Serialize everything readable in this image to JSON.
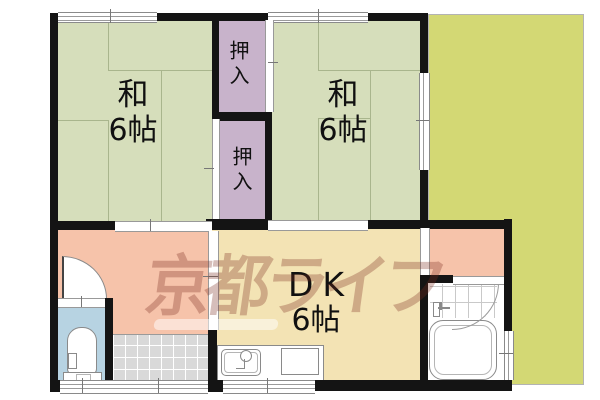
{
  "floorplan": {
    "rooms": {
      "washitsu1": {
        "name": "和",
        "size": "6帖"
      },
      "washitsu2": {
        "name": "和",
        "size": "6帖"
      },
      "dk": {
        "name": "DK",
        "size": "6帖"
      },
      "closet1": {
        "label": "押入"
      },
      "closet2": {
        "label": "押入"
      }
    },
    "watermark": {
      "text": "京都ライフ"
    },
    "colors": {
      "wall": "#141414",
      "washitsu": "#d6debb",
      "tatami-line": "#a9b58d",
      "closet": "#c8b3cb",
      "garden": "#d3d874",
      "hallway": "#f6c3aa",
      "dk": "#f3e3b4",
      "toilet": "#b7d3e2",
      "tile": "#d9d9d9",
      "watermark": "#7a2b1e"
    }
  }
}
